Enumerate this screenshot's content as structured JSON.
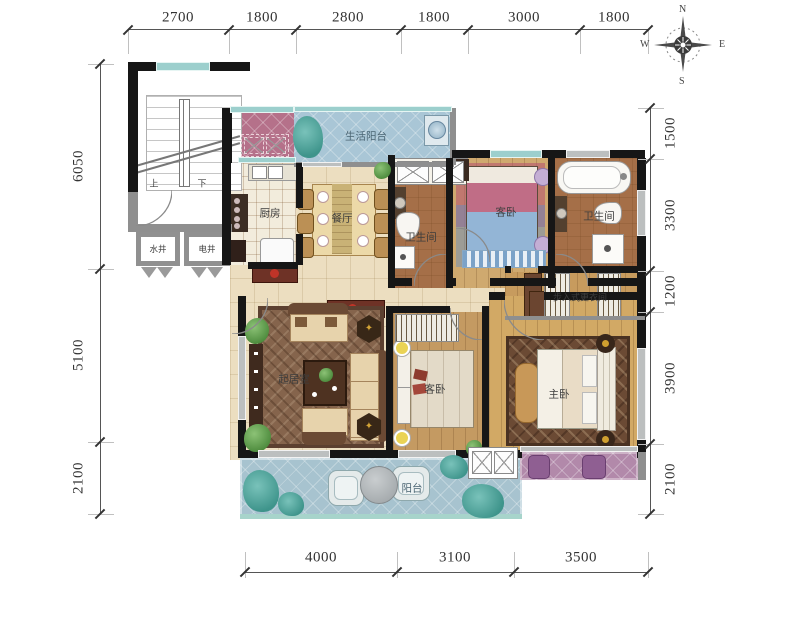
{
  "compass": {
    "north": "N",
    "east": "E",
    "south": "S",
    "west": "W"
  },
  "dimensions": {
    "top": [
      "2700",
      "1800",
      "2800",
      "1800",
      "3000",
      "1800"
    ],
    "left": [
      "6050",
      "5100",
      "2100"
    ],
    "right": [
      "1500",
      "3300",
      "1200",
      "3900",
      "2100"
    ],
    "bottom": [
      "4000",
      "3100",
      "3500"
    ]
  },
  "rooms": {
    "service_balcony": "生活阳台",
    "kitchen": "厨房",
    "dining": "餐厅",
    "bathroom_1": "卫生间",
    "guest_bedroom_top": "客卧",
    "bathroom_2": "卫生间",
    "walk_in_closet": "步入式更衣间",
    "living_room": "起居室",
    "guest_bedroom_mid": "客卧",
    "master_bedroom": "主卧",
    "balcony": "阳台",
    "water_shaft": "水井",
    "electrical_shaft": "电井"
  },
  "stairs": {
    "up": "上",
    "down": "下"
  },
  "colors": {
    "balcony_blue": "#a7c3cf",
    "bathroom_tile": "#a56f48",
    "wood_floor": "#c9a266",
    "hall_tile": "#ecdec0",
    "accent_pink": "#b5718a",
    "accent_purple": "#b289aa",
    "window_teal": "#9ccfcd",
    "wall_black": "#161616"
  }
}
